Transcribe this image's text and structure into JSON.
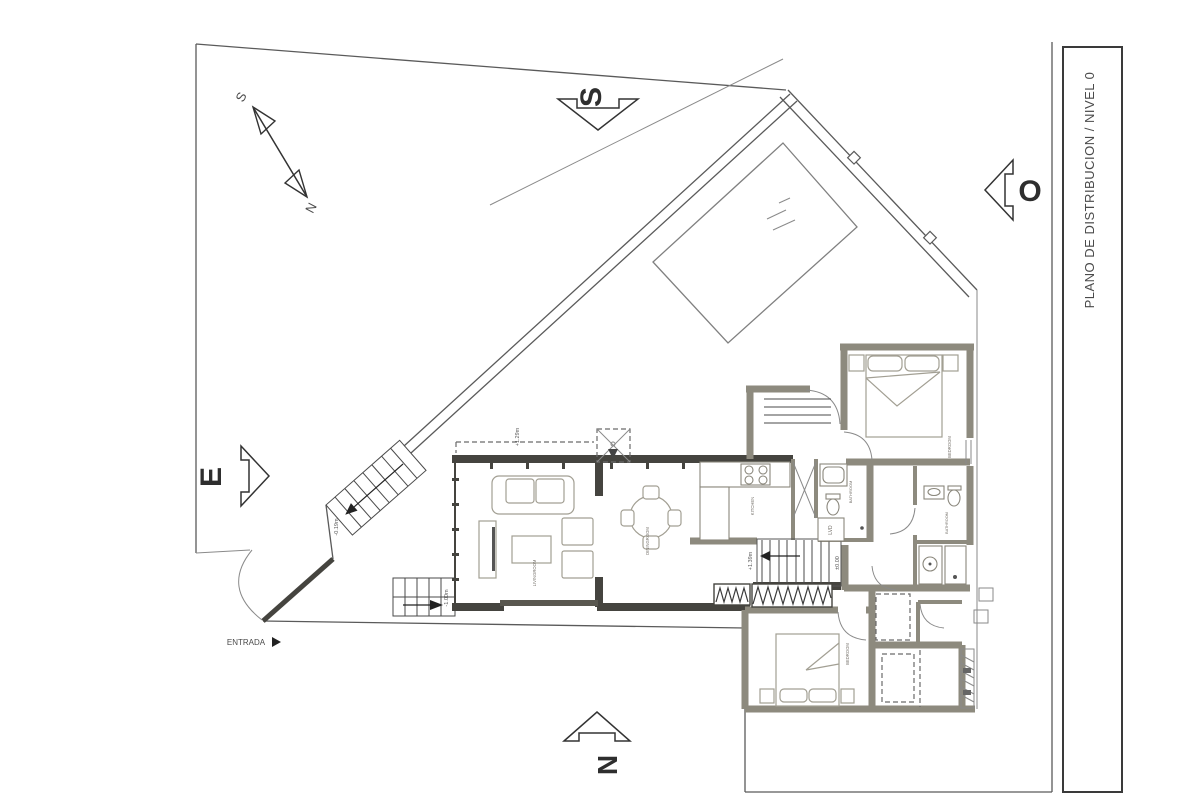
{
  "drawing": {
    "title": "PLANO DE DISTRIBUCION / NIVEL 0"
  },
  "orientation": {
    "top": "S",
    "right": "O",
    "left": "E",
    "bottom": "N",
    "compass_top": "S",
    "compass_bottom": "N"
  },
  "entrance": {
    "label": "ENTRADA"
  },
  "levels": {
    "roof_overhang": "+1.29m",
    "stair_upper": "+1.39m",
    "ground_floor": "±0.00",
    "exterior_stair": "-0.19m",
    "garden": "-1.00m"
  },
  "rooms": {
    "living": "LIVINGROOM",
    "dining": "DININGROOM",
    "kitchen": "KITCHEN",
    "bathroom": "BATHROOM",
    "laundry": "LVD",
    "bedroom_main": "BEDROOM",
    "bedroom_second": "BEDROOM",
    "bathroom_suite": "BATHROOM"
  },
  "colors": {
    "wall_dark": "#45443f",
    "wall_gray": "#8d8a7e",
    "line": "#4a4a4a",
    "furniture": "#a29f93"
  }
}
